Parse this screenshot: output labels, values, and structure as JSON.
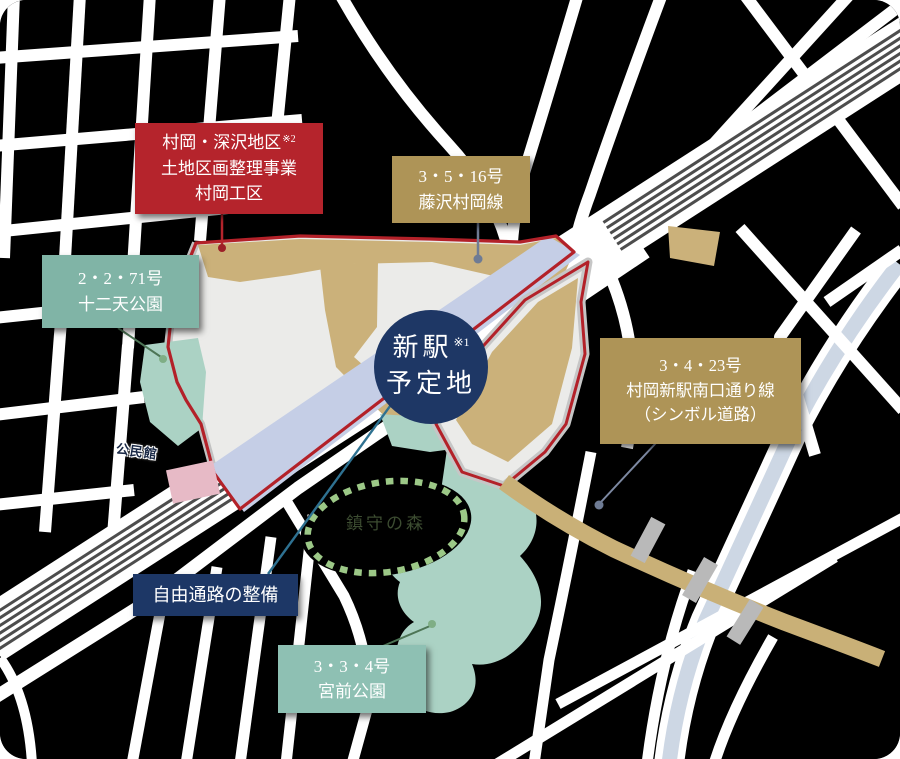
{
  "map": {
    "station": {
      "line1": "新駅",
      "note": "※1",
      "line2": "予定地"
    },
    "labels": {
      "district": {
        "line1": "村岡・深沢地区",
        "note": "※2",
        "line2": "土地区画整理事業",
        "line3": "村岡工区"
      },
      "route_3_5_16": {
        "line1": "3・5・16号",
        "line2": "藤沢村岡線"
      },
      "route_2_2_71": {
        "line1": "2・2・71号",
        "line2": "十二天公園"
      },
      "route_3_4_23": {
        "line1": "3・4・23号",
        "line2": "村岡新駅南口通り線",
        "line3": "（シンボル道路）"
      },
      "free_passage": {
        "label": "自由通路の整備"
      },
      "route_3_3_4": {
        "line1": "3・3・4号",
        "line2": "宮前公園"
      }
    },
    "annotations": {
      "community_center": "公民館",
      "shrine_forest": "鎮守の森"
    },
    "colors": {
      "background": "#000000",
      "road_white": "#ffffff",
      "project_area_fill": "#ebebe9",
      "boundary_red": "#b32129",
      "gold_road": "#cbb17a",
      "label_red": "#b5242c",
      "label_gold": "#ae9457",
      "label_teal": "#80b4a6",
      "label_navy": "#1d3766",
      "park_teal": "#abd2c4",
      "rail_band_blue": "#c5cee6",
      "river_blue": "#cdd7e4",
      "forest_dash_green": "#9cc887",
      "building_pink": "#e7bac6",
      "track_gray": "#4d4d4d"
    }
  }
}
